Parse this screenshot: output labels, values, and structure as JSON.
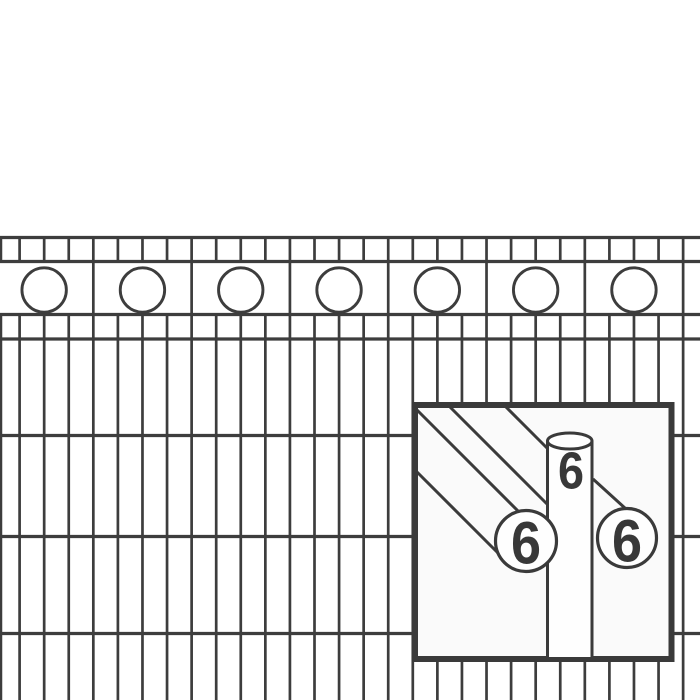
{
  "title": "Decorative double-wire fence panel product illustration",
  "colors": {
    "background": "#ffffff",
    "wire": "#3d3d3d",
    "inset_border": "#3a3a3a",
    "inset_fill": "#fafafa",
    "shape_fill": "#fefefe",
    "label": "#383838"
  },
  "fence": {
    "horizontal_wire_y": [
      237.5,
      261.5,
      314.5,
      339,
      435.5,
      536.5,
      633.5
    ],
    "wire_thickness": 3.2,
    "bar_thickness": 2.7,
    "bar_start_x": 19.6,
    "bar_spacing": 24.575,
    "bar_count": 28,
    "edge_bar_x": 0.9,
    "separator_offset_index": 3,
    "separator_every": 4,
    "top_band_top": 236,
    "top_band_bottom": 263,
    "lower_band_top": 313,
    "bottom": 700,
    "ornament_circles": {
      "count": 7,
      "first_cx": 44.15,
      "spacing": 98.3,
      "cy": 290,
      "r": 22.2,
      "stroke": 2.9
    }
  },
  "inset": {
    "box": {
      "x": 415,
      "y": 405,
      "width": 256.5,
      "height": 254,
      "border": 6
    },
    "line_thickness": 3,
    "cylinder": {
      "x1": 547.5,
      "x2": 592,
      "top": 441,
      "bottom": 657,
      "ellipse_ry": 8
    },
    "rod_lines": [
      [
        415,
        408,
        520,
        513
      ],
      [
        448,
        405,
        547,
        504
      ],
      [
        504,
        405,
        548,
        449
      ],
      [
        413,
        468,
        500,
        555
      ],
      [
        593,
        479,
        626,
        509
      ]
    ],
    "end_circles": [
      {
        "cx": 526,
        "cy": 541,
        "r": 30.5
      },
      {
        "cx": 627,
        "cy": 538,
        "r": 29.5
      }
    ],
    "labels": [
      {
        "text": "6",
        "x": 526,
        "y": 542,
        "size": 60
      },
      {
        "text": "6",
        "x": 627,
        "y": 540,
        "size": 60
      },
      {
        "text": "6",
        "x": 571,
        "y": 470,
        "size": 52
      }
    ]
  }
}
